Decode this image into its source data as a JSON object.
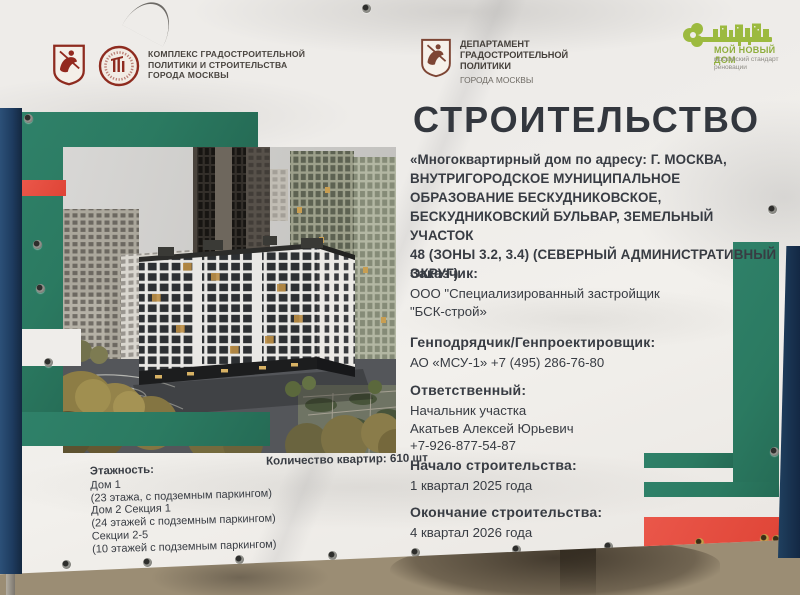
{
  "colors": {
    "green": "#2b7a61",
    "red": "#e14b3e",
    "navy": "#1e3c60",
    "text": "#383c43",
    "logo_green": "#8fae3e"
  },
  "header": {
    "left": {
      "icon": "moscow-coat-of-arms-icon",
      "seal_icon": "stroycomplex-seal-icon",
      "org": "КОМПЛЕКС ГРАДОСТРОИТЕЛЬНОЙ\nПОЛИТИКИ И СТРОИТЕЛЬСТВА\nГОРОДА МОСКВЫ"
    },
    "center": {
      "icon": "moscow-coat-of-arms-icon",
      "org": "ДЕПАРТАМЕНТ\nГРАДОСТРОИТЕЛЬНОЙ\nПОЛИТИКИ",
      "org_sub": "ГОРОДА МОСКВЫ"
    },
    "right": {
      "icon": "my-new-home-key-icon",
      "name": "МОЙ НОВЫЙ ДОМ",
      "subtitle": "московский стандарт\nреновации"
    }
  },
  "main": {
    "title": "СТРОИТЕЛЬСТВО",
    "address": "«Многоквартирный дом по адресу: Г. МОСКВА,\nВНУТРИГОРОДСКОЕ МУНИЦИПАЛЬНОЕ\nОБРАЗОВАНИЕ БЕСКУДНИКОВСКОЕ,\nБЕСКУДНИКОВСКИЙ БУЛЬВАР, ЗЕМЕЛЬНЫЙ УЧАСТОК\n48 (ЗОНЫ 3.2, 3.4) (СЕВЕРНЫЙ АДМИНИСТРАТИВНЫЙ\nОКРУГ)",
    "sections": [
      {
        "label": "Заказчик:",
        "value": "ООО \"Специализированный застройщик\n\"БСК-строй»"
      },
      {
        "label": "Генподрядчик/Генпроектировщик:",
        "value": "АО «МСУ-1» +7 (495) 286-76-80"
      },
      {
        "label": "Ответственный:",
        "value": "Начальник участка\nАкатьев Алексей Юрьевич\n+7-926-877-54-87"
      },
      {
        "label": "Начало строительства:",
        "value": "1 квартал 2025 года"
      },
      {
        "label": "Окончание строительства:",
        "value": "4 квартал 2026 года"
      }
    ]
  },
  "details": {
    "floors_label": "Этажность:",
    "floors": "Дом 1\n(23 этажа, с подземным паркингом)\nДом 2 Секция 1\n(24 этажей с подземным паркингом)\nСекции 2-5\n(10 этажей с подземным паркингом)",
    "apartments_label": "Количество квартир:",
    "apartments_value": "610 шт"
  }
}
